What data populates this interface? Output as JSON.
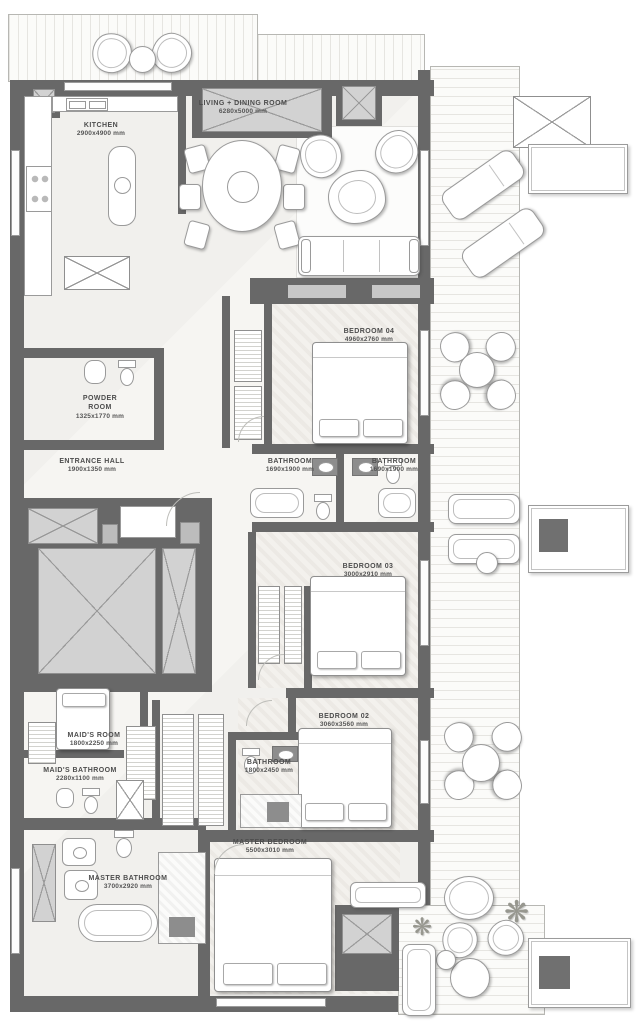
{
  "meta": {
    "drawing_type": "apartment floor plan"
  },
  "colors": {
    "wall": "#686868",
    "shaft_fill": "#d2d2d2",
    "floor": "#f6f5f2",
    "accent_square": "#707070",
    "label_text": "#4d4d4d"
  },
  "rooms": {
    "kitchen": {
      "name": "KITCHEN",
      "dims": "2900x4900 mm"
    },
    "living_dining": {
      "name": "LIVING + DINING ROOM",
      "dims": "6280x5000 mm"
    },
    "bedroom_04": {
      "name": "BEDROOM 04",
      "dims": "4960x2760 mm"
    },
    "powder_room": {
      "name": "POWDER ROOM",
      "dims": "1325x1770 mm"
    },
    "entrance_hall": {
      "name": "ENTRANCE HALL",
      "dims": "1900x1350 mm"
    },
    "bathroom_a": {
      "name": "BATHROOM",
      "dims": "1690x1900 mm"
    },
    "bathroom_b": {
      "name": "BATHROOM",
      "dims": "1690x1900 mm"
    },
    "bedroom_03": {
      "name": "BEDROOM 03",
      "dims": "3000x2910 mm"
    },
    "bedroom_02": {
      "name": "BEDROOM 02",
      "dims": "3060x3560 mm"
    },
    "maids_room": {
      "name": "MAID'S ROOM",
      "dims": "1800x2250 mm"
    },
    "maids_bathroom": {
      "name": "MAID'S BATHROOM",
      "dims": "2280x1100 mm"
    },
    "bathroom_c": {
      "name": "BATHROOM",
      "dims": "1800x2450 mm"
    },
    "master_bedroom": {
      "name": "MASTER BEDROOM",
      "dims": "5500x3010 mm"
    },
    "master_bathroom": {
      "name": "MASTER BATHROOM",
      "dims": "3700x2920 mm"
    }
  },
  "icons": {
    "plant": "❋"
  }
}
